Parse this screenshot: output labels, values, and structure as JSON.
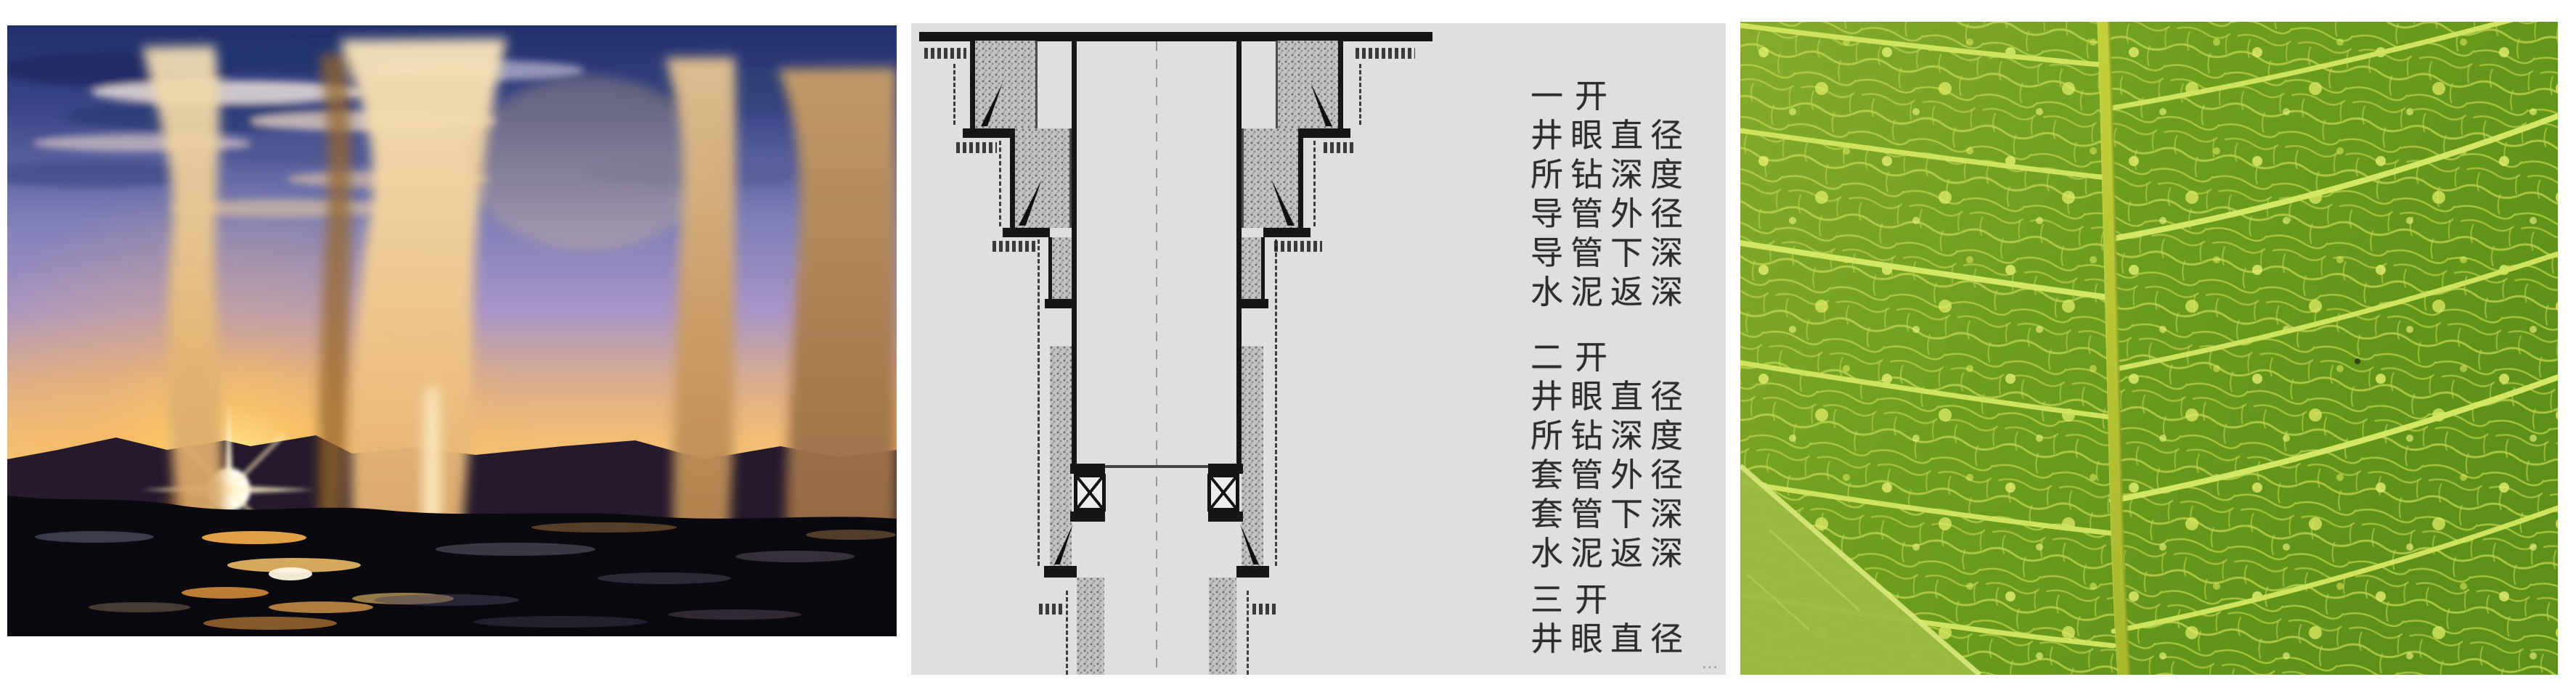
{
  "figure": {
    "kind": "three-panel illustration strip",
    "diagram": {
      "sections": [
        {
          "title": "一开",
          "lines": [
            "井眼直径",
            "所钻深度",
            "导管外径",
            "导管下深",
            "水泥返深"
          ]
        },
        {
          "title": "二开",
          "lines": [
            "井眼直径",
            "所钻深度",
            "套管外径",
            "套管下深",
            "水泥返深"
          ]
        },
        {
          "title": "三开",
          "lines": [
            "井眼直径"
          ]
        }
      ],
      "truncation": "…",
      "colors": {
        "panel_bg": "#dfdfdf",
        "ink": "#161616",
        "cement_fill": "#c3c3c3"
      }
    },
    "photos": {
      "geyser_colors": {
        "sky_top": "#25356f",
        "sky_mid": "#8d8cc4",
        "horizon": "#f2bd72",
        "sun_core": "#fffdf2",
        "plume": "#d9a96a",
        "foreground": "#0a0910"
      },
      "leaf_colors": {
        "blade_green": "#6f9e1e",
        "vein_yellow": "#cfe35e",
        "midrib": "#b5c433",
        "overlay_edge": "#9cba42"
      }
    }
  }
}
